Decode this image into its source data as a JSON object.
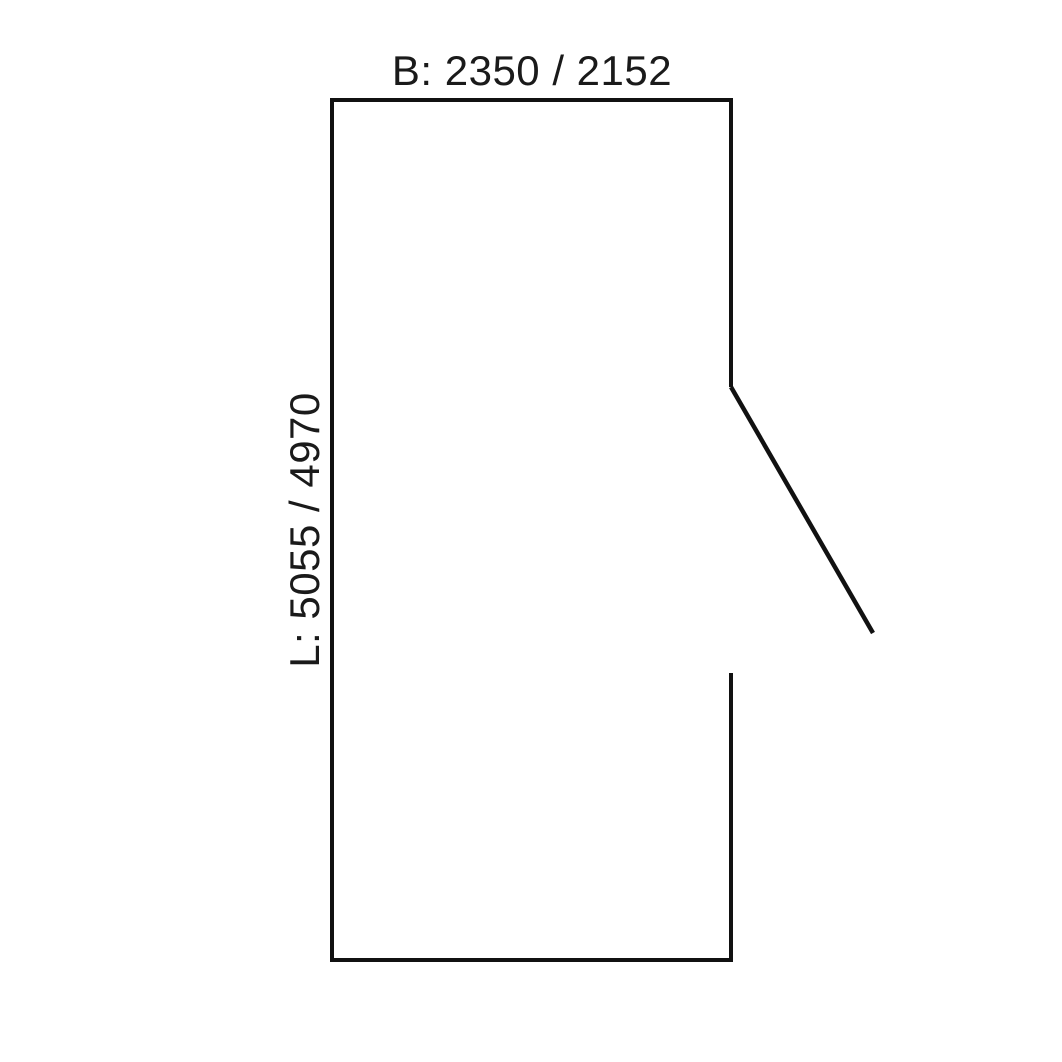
{
  "diagram": {
    "top_label": "B: 2350 / 2152",
    "left_label": "L: 5055 / 4970",
    "width_dimension": {
      "prefix": "B:",
      "values": [
        "2350",
        "2152"
      ]
    },
    "length_dimension": {
      "prefix": "L:",
      "values": [
        "5055",
        "4970"
      ]
    },
    "line_color": "#111111",
    "text_color": "#1a1a1a",
    "background_color": "#ffffff"
  }
}
